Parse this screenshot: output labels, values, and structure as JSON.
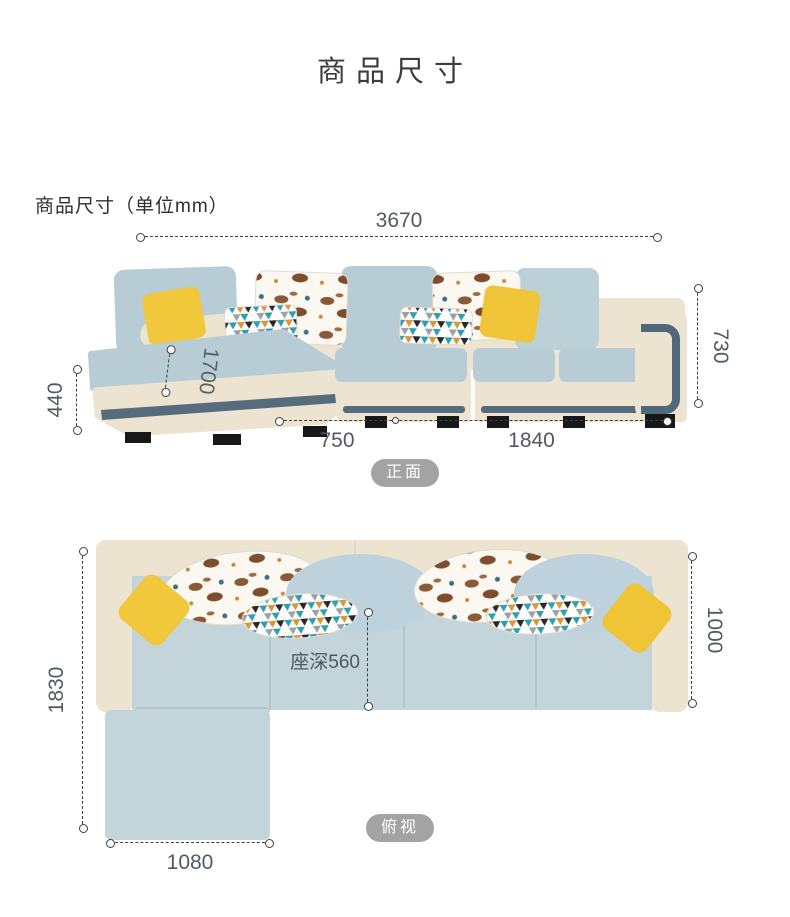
{
  "page": {
    "title": "商品尺寸",
    "section_heading": "商品尺寸（单位mm）"
  },
  "front_view": {
    "badge": "正面",
    "dims": {
      "total_width": "3670",
      "height": "730",
      "seat_height": "440",
      "chaise_length": "1700",
      "left_width": "750",
      "right_width": "1840"
    }
  },
  "top_view": {
    "badge": "俯视",
    "dims": {
      "total_depth": "1830",
      "body_depth": "1000",
      "seat_depth": "座深560",
      "chaise_width": "1080"
    }
  },
  "colors": {
    "sofa_cream": "#ece3d0",
    "sofa_blue": "#b7ccd5",
    "sofa_blue_top": "#c3d4da",
    "accent_yellow": "#f1c73c",
    "trim_slate": "#566c7c",
    "pillow_horse_brown": "#8a5a38",
    "pillow_geo_teal": "#2f9fae",
    "pillow_geo_orange": "#d8963f",
    "badge_gray": "#a3a3a3",
    "dim_line": "#3f3f3f",
    "dim_text": "#525a61"
  }
}
